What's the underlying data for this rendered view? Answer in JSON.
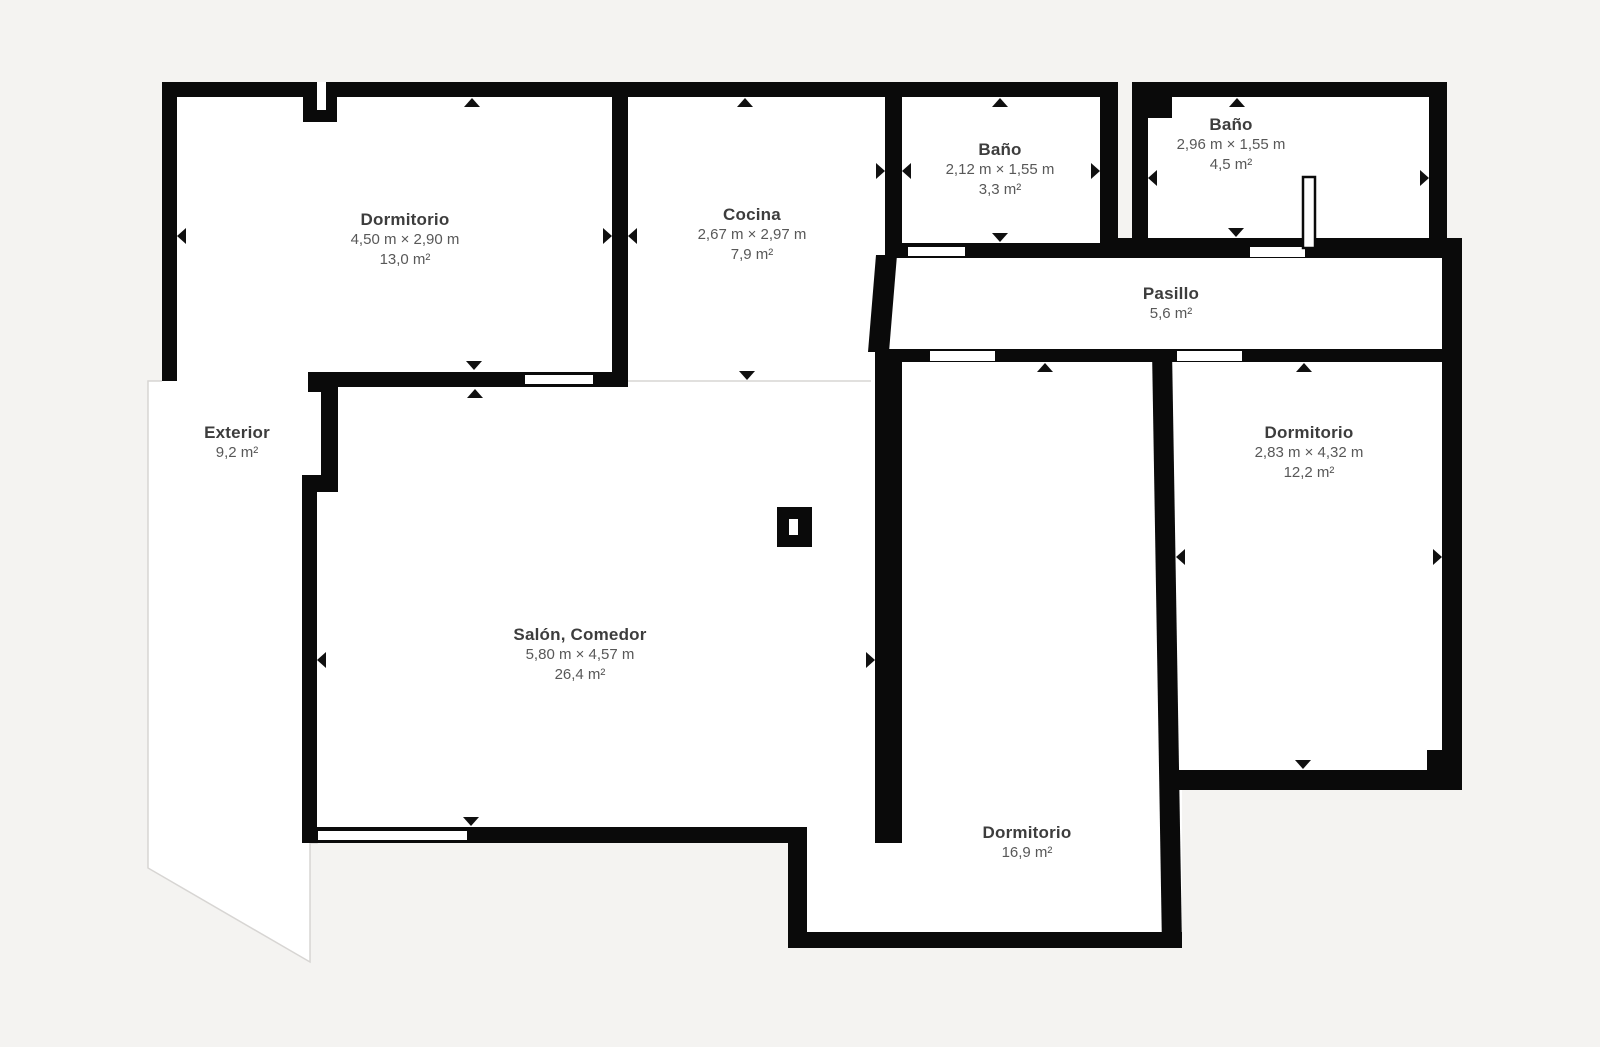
{
  "plan": {
    "title": "Floor plan",
    "background_color": "#f4f3f1",
    "floor_color": "#ffffff",
    "wall_color": "#0a0a0a",
    "outline_color": "#d7d5d3",
    "room_name_color": "#3d3d3d",
    "room_meta_color": "#585858",
    "rooms": [
      {
        "id": "dormitorio-1",
        "name": "Dormitorio",
        "dims": "4,50 m × 2,90 m",
        "area": "13,0 m²"
      },
      {
        "id": "cocina",
        "name": "Cocina",
        "dims": "2,67 m × 2,97 m",
        "area": "7,9 m²"
      },
      {
        "id": "bano-1",
        "name": "Baño",
        "dims": "2,12 m × 1,55 m",
        "area": "3,3 m²"
      },
      {
        "id": "bano-2",
        "name": "Baño",
        "dims": "2,96 m × 1,55 m",
        "area": "4,5 m²"
      },
      {
        "id": "pasillo",
        "name": "Pasillo",
        "dims": "",
        "area": "5,6 m²"
      },
      {
        "id": "exterior",
        "name": "Exterior",
        "dims": "",
        "area": "9,2 m²"
      },
      {
        "id": "salon-comedor",
        "name": "Salón, Comedor",
        "dims": "5,80 m × 4,57 m",
        "area": "26,4 m²"
      },
      {
        "id": "dormitorio-2",
        "name": "Dormitorio",
        "dims": "2,83 m × 4,32 m",
        "area": "12,2 m²"
      },
      {
        "id": "dormitorio-3",
        "name": "Dormitorio",
        "dims": "",
        "area": "16,9 m²"
      }
    ]
  }
}
